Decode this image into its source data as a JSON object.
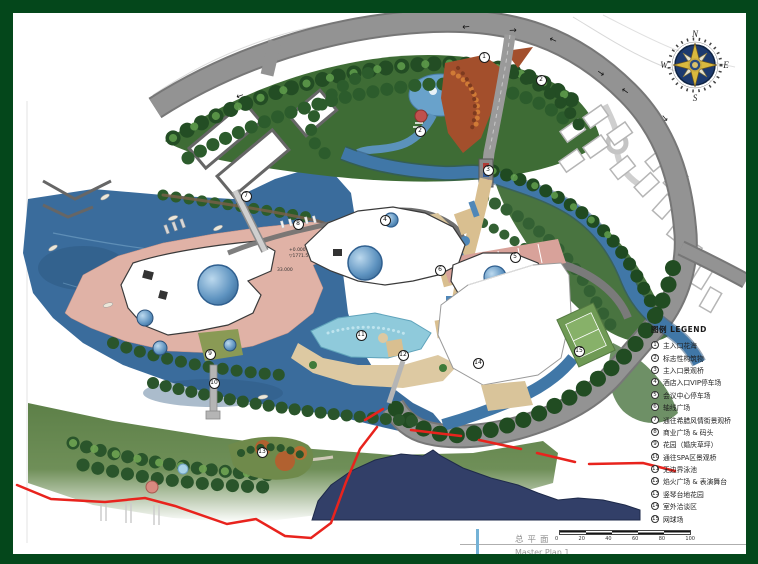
{
  "sheet_title": {
    "cn": "总平面",
    "en": "Master Plan 1"
  },
  "legend": {
    "title": "图例 LEGEND",
    "items": [
      {
        "num": "1",
        "label": "主入口花海"
      },
      {
        "num": "2",
        "label": "标志性构筑物"
      },
      {
        "num": "3",
        "label": "主入口景观桥"
      },
      {
        "num": "4",
        "label": "酒店入口VIP停车场"
      },
      {
        "num": "5",
        "label": "会议中心停车场"
      },
      {
        "num": "6",
        "label": "轴线广场"
      },
      {
        "num": "7",
        "label": "通往希腊风情街景观桥"
      },
      {
        "num": "8",
        "label": "商业广场 & 码头"
      },
      {
        "num": "9",
        "label": "花园（婚庆草坪）"
      },
      {
        "num": "10",
        "label": "通往SPA区景观桥"
      },
      {
        "num": "11",
        "label": "无边界泳池"
      },
      {
        "num": "12",
        "label": "焰火广场 & 表演舞台"
      },
      {
        "num": "13",
        "label": "竖琴台地花园"
      },
      {
        "num": "14",
        "label": "室外洽谈区"
      },
      {
        "num": "15",
        "label": "网球场"
      }
    ]
  },
  "markers": [
    {
      "num": "1",
      "x": 471,
      "y": 44
    },
    {
      "num": "2",
      "x": 528,
      "y": 67
    },
    {
      "num": "2",
      "x": 407,
      "y": 118
    },
    {
      "num": "3",
      "x": 475,
      "y": 157
    },
    {
      "num": "4",
      "x": 372,
      "y": 207
    },
    {
      "num": "5",
      "x": 502,
      "y": 244
    },
    {
      "num": "6",
      "x": 427,
      "y": 257
    },
    {
      "num": "7",
      "x": 233,
      "y": 183
    },
    {
      "num": "8",
      "x": 285,
      "y": 211
    },
    {
      "num": "9",
      "x": 197,
      "y": 341
    },
    {
      "num": "10",
      "x": 201,
      "y": 370
    },
    {
      "num": "11",
      "x": 348,
      "y": 322
    },
    {
      "num": "12",
      "x": 390,
      "y": 342
    },
    {
      "num": "13",
      "x": 249,
      "y": 439
    },
    {
      "num": "14",
      "x": 465,
      "y": 350
    },
    {
      "num": "15",
      "x": 566,
      "y": 338
    }
  ],
  "compass": {
    "n": "N",
    "e": "E",
    "s": "S",
    "w": "W"
  },
  "scalebar": {
    "labels": [
      "0",
      "20",
      "40",
      "60",
      "80",
      "100"
    ]
  },
  "elevation": {
    "datum": "+0.000",
    "level": "▽1771.5",
    "height": "33.000"
  },
  "colors": {
    "frame_green": "#04471b",
    "boundary_red": "#e8231d",
    "lake_blue": "#3a6c9c",
    "mountain_navy": "#323f68",
    "road_gray": "#8f8f8f",
    "forest_green": "#3e6c35",
    "promenade_pink": "#e0b2a6",
    "parking_salmon": "#d8a29a",
    "pool_turquoise": "#8fcadb"
  }
}
